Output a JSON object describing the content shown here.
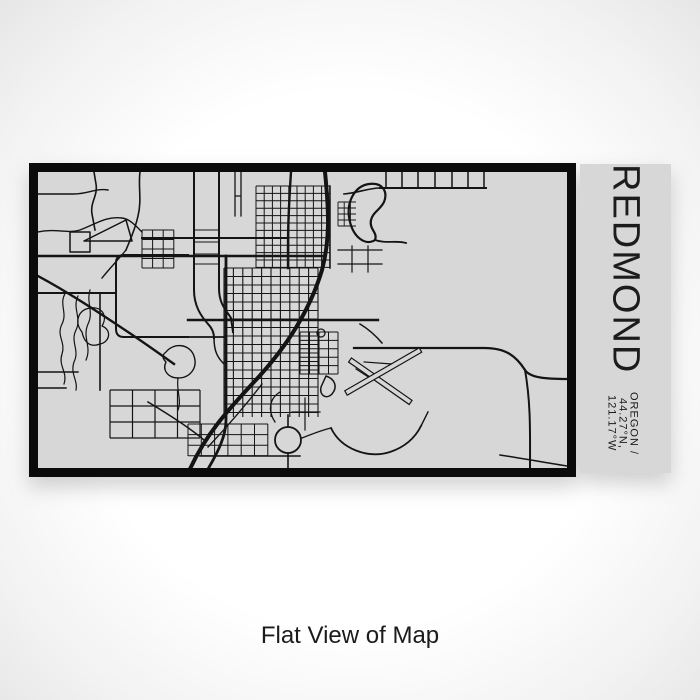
{
  "product": {
    "title": "REDMOND",
    "subtitle": "OREGON / 44.27°N, 121.17°W",
    "caption": "Flat View of Map"
  },
  "colors": {
    "map_bg": "#d7d7d7",
    "panel_bg": "#d7d7d7",
    "road": "#141414",
    "frame": "#0b0b0b",
    "text": "#1c1c1c",
    "caption_text": "#1b1b1b",
    "page_center": "#ffffff",
    "page_edge": "#cdced0"
  },
  "map": {
    "viewbox": "0 0 529 296",
    "roads": [
      {
        "d": "M287,0 C291,40 292,68 284,98 C272,138 248,176 216,210 C190,238 168,262 152,297",
        "w": 4
      },
      {
        "d": "M253,0 C251,30 250,52 250,74 L250,96",
        "w": 2.4
      },
      {
        "d": "M188,84 L188,248 C188,264 180,280 170,297",
        "w": 2.8
      },
      {
        "d": "M0,84 L286,84",
        "w": 2.6
      },
      {
        "d": "M150,148 L340,148",
        "w": 2.4
      },
      {
        "d": "M0,121 L78,121",
        "w": 2
      },
      {
        "d": "M104,66 L250,66",
        "w": 2
      },
      {
        "d": "M342,16 L448,16",
        "w": 2
      },
      {
        "d": "M348,0 L348,16 M364,0 L364,16 M380,0 L380,16 M397,0 L397,16 M414,0 L414,16 M430,0 L430,16 M446,0 L446,16",
        "w": 1.5
      },
      {
        "d": "M306,22 C320,21 330,16 342,16",
        "w": 1.6
      },
      {
        "d": "M316,176 L446,176 C468,176 478,184 487,198 C492,206 509,207 529,207",
        "w": 2.2
      },
      {
        "d": "M487,198 C493,232 492,262 492,297",
        "w": 2
      },
      {
        "d": "M156,0 L156,118 C156,134 163,144 170,152 C174,156 176,160 176,166",
        "w": 2
      },
      {
        "d": "M181,0 L181,116 C181,132 188,138 193,146 L195,160",
        "w": 2
      },
      {
        "d": "M157,58 L181,58 M157,70 L181,70 M157,82 L181,82 M157,92 L181,92",
        "w": 1.1
      },
      {
        "d": "M0,104 C30,120 60,140 90,160 C105,170 122,182 136,192",
        "w": 2.4
      },
      {
        "d": "M150,83 L86,83 Q78,83 78,91 L78,157 Q78,165 86,165 L150,165",
        "w": 2
      },
      {
        "d": "M150,165 L186,165",
        "w": 1.8
      },
      {
        "d": "M56,0 L58,12 C60,24 52,30 54,42 L57,58",
        "w": 1.6
      },
      {
        "d": "M102,0 C100,14 104,28 100,44 C97,58 92,68 88,78",
        "w": 1.6
      },
      {
        "d": "M88,78 C80,88 72,96 64,106",
        "w": 1.4
      },
      {
        "d": "M0,22 L36,22 C50,22 58,16 70,18",
        "w": 1.4
      },
      {
        "d": "M0,60 C18,56 30,62 42,58 C58,52 68,44 84,46 C92,47 98,54 104,60",
        "w": 1.4
      },
      {
        "d": "M46,69 L88,48 L94,69 Z",
        "w": 1.5
      },
      {
        "d": "M32,60 L52,60 L52,80 L32,80 Z",
        "w": 1.5
      },
      {
        "d": "M62,121 L62,218",
        "w": 1.6
      },
      {
        "d": "M0,200 L40,200 M0,216 L28,216",
        "w": 1.4
      },
      {
        "d": "M110,230 C130,242 152,256 166,268",
        "w": 1.6
      },
      {
        "d": "M162,284 L262,284",
        "w": 1.5
      },
      {
        "d": "M224,212 C204,238 186,258 170,275",
        "w": 1.4
      },
      {
        "d": "M250,255 L250,243 M250,281 L250,297",
        "w": 1.6
      },
      {
        "d": "M237,250 C229,238 232,226 242,220",
        "w": 1.3
      },
      {
        "d": "M264,266 C274,262 284,258 293,256",
        "w": 1.4
      },
      {
        "d": "M293,256 C303,277 330,287 352,280 C367,275 377,266 383,254",
        "w": 1.8
      },
      {
        "d": "M383,254 L390,240",
        "w": 1.4
      },
      {
        "d": "M288,204 C297,207 300,215 294,222 C288,228 281,223 283,215 Z",
        "w": 1.5
      },
      {
        "d": "M462,283 C488,287 510,291 529,294",
        "w": 1.5
      },
      {
        "d": "M28,120 C20,132 30,140 24,152 C18,164 28,170 24,182 C20,194 30,200 26,212",
        "w": 1.2
      },
      {
        "d": "M40,124 C34,136 44,146 38,158 C32,170 42,178 36,190 C32,202 40,208 38,218",
        "w": 1.2
      },
      {
        "d": "M52,118 C48,130 56,140 50,152 C44,166 54,174 48,188",
        "w": 1.2
      },
      {
        "d": "M44,160 C36,150 40,138 52,136 C64,134 70,144 64,154 C74,158 72,170 62,172 C52,176 46,170 44,160 Z",
        "w": 1.3
      },
      {
        "d": "M128,180 C136,170 152,172 156,184 C160,196 152,206 140,206 C130,206 124,198 128,190 C124,186 124,183 128,180 Z",
        "w": 1.4
      },
      {
        "d": "M140,206 C138,218 144,228 140,238",
        "w": 1.2
      },
      {
        "d": "M312,50 C307,30 317,14 331,12 C345,10 350,20 346,30 C342,38 335,40 333,48 C331,58 340,60 337,68 C328,74 316,66 312,50 Z",
        "w": 2.2
      },
      {
        "d": "M337,68 C348,72 358,68 368,71",
        "w": 1.8
      },
      {
        "d": "M322,152 C332,158 338,164 344,171",
        "w": 1.5
      },
      {
        "d": "M292,14 L292,96",
        "w": 1.5
      },
      {
        "d": "M326,190 L354,192 M318,197 L332,206",
        "w": 1.2
      },
      {
        "d": "M197,0 L197,44 M203,0 L203,44 M197,24 L203,24",
        "w": 1.3
      },
      {
        "d": "M300,78 L344,78 M300,92 L344,92 M314,74 L314,100 M330,74 L330,100",
        "w": 1.2
      },
      {
        "d": "M267,226 L267,258 M254,240 L282,240",
        "w": 1.2
      },
      {
        "d": "M176,166 C176,180 180,186 186,192",
        "w": 1.5
      }
    ],
    "grids": [
      {
        "x0": 186,
        "y0": 96,
        "x1": 280,
        "y1": 245,
        "dx": 9.4,
        "dy": 8.5,
        "w": 1.1
      },
      {
        "x0": 218,
        "y0": 14,
        "x1": 292,
        "y1": 96,
        "dx": 8.2,
        "dy": 7.4,
        "w": 1
      },
      {
        "x0": 72,
        "y0": 218,
        "x1": 162,
        "y1": 266,
        "dx": 22.5,
        "dy": 16,
        "w": 1.2
      },
      {
        "x0": 104,
        "y0": 58,
        "x1": 136,
        "y1": 96,
        "dx": 10.6,
        "dy": 9.5,
        "w": 1
      },
      {
        "x0": 150,
        "y0": 252,
        "x1": 230,
        "y1": 284,
        "dx": 13.3,
        "dy": 10.6,
        "w": 1
      },
      {
        "x0": 262,
        "y0": 160,
        "x1": 300,
        "y1": 202,
        "dx": 9.5,
        "dy": 8.4,
        "w": 1
      },
      {
        "x0": 300,
        "y0": 30,
        "x1": 318,
        "y1": 54,
        "dx": 6.2,
        "dy": 6,
        "w": 0.9
      }
    ],
    "runways": [
      {
        "x": 312,
        "y": 188,
        "len": 74,
        "wid": 5,
        "angle": 35
      },
      {
        "x": 308,
        "y": 221,
        "len": 86,
        "wid": 5,
        "angle": -30
      }
    ],
    "circles": [
      {
        "cx": 250,
        "cy": 268,
        "r": 13,
        "w": 1.8
      },
      {
        "cx": 283,
        "cy": 161,
        "r": 4,
        "w": 1.3
      }
    ]
  }
}
